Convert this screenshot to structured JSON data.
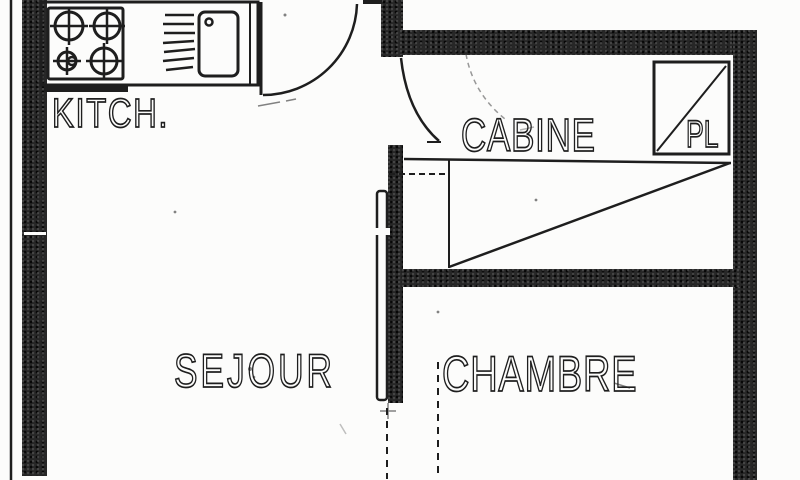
{
  "plan": {
    "rooms": {
      "kitchen": {
        "label": "KITCH."
      },
      "cabine": {
        "label": "CABINE"
      },
      "closet": {
        "label": "PL"
      },
      "living": {
        "label": "SEJOUR"
      },
      "bedroom": {
        "label": "CHAMBRE"
      }
    },
    "icons": {
      "stove": "stove-burners-icon",
      "sink": "sink-basin-icon",
      "drainer": "dish-drainer-icon",
      "entry_door": "door-swing-arc-icon",
      "cabine_door": "door-swing-arc-icon",
      "wardrobe": "closet-diagonal-icon",
      "pl_closet": "closet-diagonal-icon"
    },
    "colors": {
      "ink": "#1e1e1e",
      "wall": "#272727",
      "paper": "#fcfcfb"
    }
  }
}
